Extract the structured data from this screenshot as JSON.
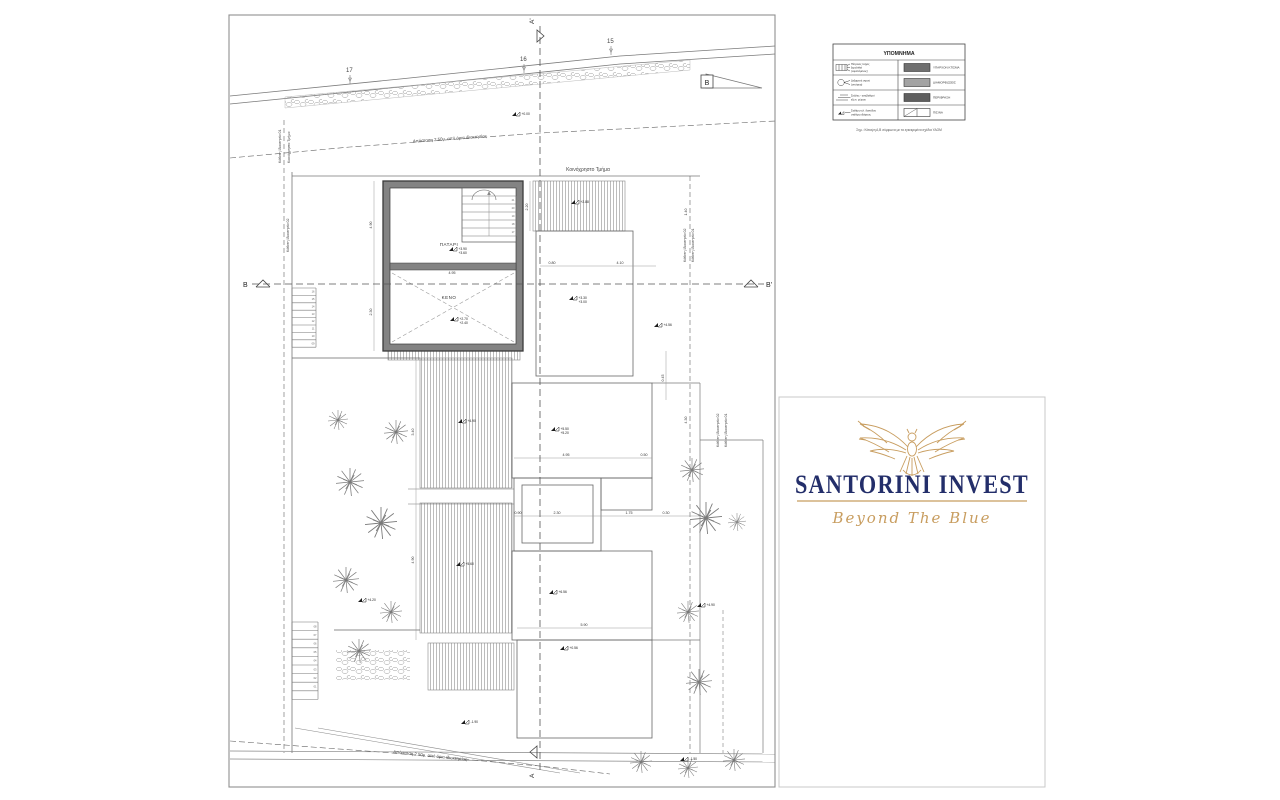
{
  "legend": {
    "title": "ΥΠΟΜΝΗΜΑ",
    "note": "Σημ.: Κάτοψη Α,Β σύμφωνα με τα εγκεκριμένα σχέδια ΥΔΟΜ",
    "rows": [
      {
        "symbol": "wall-marker",
        "label_lines": [
          "Πέτρινος τοίχος",
          "ξερολιθιά",
          "(υφιστάμενος)"
        ],
        "swatch": "#6f6f6f",
        "swatch_style": "solid",
        "swatch_label": "ΥΠΑΡΧΟΝ ΚΤΙΣΜΑ"
      },
      {
        "symbol": "circle-marker",
        "label_lines": [
          "Δεξαμενή νερού",
          "(υπόγεια)"
        ],
        "swatch": "#a3a3a3",
        "swatch_style": "solid",
        "swatch_label": "ΔΙΑΜΟΡΦΩΣΕΙΣ"
      },
      {
        "symbol": "steps-marker",
        "label_lines": [
          "Σκάλες - αναβαθμοί",
          "εξωτ. χώρου"
        ],
        "swatch": "#5f5f5f",
        "swatch_style": "solid",
        "swatch_label": "ΠΕΡΙΦΡΑΞΗ"
      },
      {
        "symbol": "level-marker",
        "label_lines": [
          "Στάθμη τελ. δαπέδου",
          "στάθμη εδάφους"
        ],
        "swatch": "#ffffff",
        "swatch_style": "split",
        "swatch_label": "ΠΙΣΙΝΑ"
      }
    ]
  },
  "logo": {
    "company": "SANTORINI INVEST",
    "tagline": "Beyond The Blue",
    "navy": "#232e6a",
    "gold": "#c89d5f",
    "icon": "eagle-icon"
  },
  "plan": {
    "labels": {
      "patari": "ΠΑΤΑΡΙ",
      "keno": "ΚΕΝΟ",
      "common_top": "Κοινόχρηστο Τμήμα",
      "left_boundary_a": "Κάθετη Ιδιοκτησία 01",
      "left_boundary_b": "Κοινόχρηστο Τμήμα",
      "left_boundary_c": "Κάθετη Ιδιοκτησία 02",
      "right_boundary_a": "Κάθετη Ιδιοκτησία 02",
      "right_boundary_b": "Κάθετη Ιδιοκτησία 01",
      "right_boundary_c": "Κάθετη Ιδιοκτησία 02",
      "right_boundary_d": "Κάθετη Ιδιοκτησία 01",
      "offset_top": "Απόσταση 2.50μ. από όρια ιδιοκτησίας",
      "offset_bottom": "Απόσταση 2.50μ. από όρια ιδιοκτησίας"
    },
    "sections": {
      "a_top": "A'",
      "a_bottom": "A",
      "b_left": "B",
      "b_right": "B'",
      "b_slope": "B"
    },
    "contours": [
      [
        346,
        72,
        "17"
      ],
      [
        520,
        61,
        "16"
      ],
      [
        607,
        43,
        "15"
      ]
    ],
    "level_markers": [
      [
        512,
        116,
        "+0.00"
      ],
      [
        449,
        251,
        "+3.90",
        "+3.60"
      ],
      [
        450,
        321,
        "+2.70",
        "+2.40"
      ],
      [
        571,
        204,
        "+2.88"
      ],
      [
        569,
        300,
        "+3.30",
        "+3.00"
      ],
      [
        654,
        327,
        "+4.56"
      ],
      [
        458,
        423,
        "+4.90"
      ],
      [
        551,
        431,
        "+5.50",
        "+5.20"
      ],
      [
        358,
        602,
        "+4.20"
      ],
      [
        456,
        566,
        "+5.60"
      ],
      [
        549,
        594,
        "+6.56"
      ],
      [
        697,
        607,
        "+4.90"
      ],
      [
        680,
        761,
        "-1.50"
      ],
      [
        461,
        724,
        "-1.90"
      ],
      [
        560,
        650,
        "+0.56"
      ]
    ],
    "dimensions": [
      [
        452,
        274,
        "4.95",
        0
      ],
      [
        552,
        264,
        "0.80",
        0
      ],
      [
        620,
        264,
        "4.10",
        0
      ],
      [
        372,
        225,
        "4.90",
        -90
      ],
      [
        372,
        312,
        "2.30",
        -90
      ],
      [
        528,
        207,
        "2.20",
        -90
      ],
      [
        687,
        212,
        "1.40",
        -90
      ],
      [
        687,
        420,
        "4.30",
        -90
      ],
      [
        566,
        456,
        "4.95",
        0
      ],
      [
        644,
        456,
        "0.50",
        0
      ],
      [
        518,
        514,
        "0.90",
        0
      ],
      [
        557,
        514,
        "2.30",
        0
      ],
      [
        629,
        514,
        "1.75",
        0
      ],
      [
        666,
        514,
        "0.30",
        0
      ],
      [
        584,
        626,
        "5.90",
        0
      ],
      [
        414,
        432,
        "3.40",
        -90
      ],
      [
        414,
        560,
        "4.90",
        -90
      ],
      [
        664,
        378,
        "0.45",
        -90
      ]
    ],
    "plants": [
      [
        338,
        420,
        1.0
      ],
      [
        396,
        432,
        1.2
      ],
      [
        350,
        482,
        1.4
      ],
      [
        381,
        523,
        1.6
      ],
      [
        346,
        580,
        1.3
      ],
      [
        391,
        612,
        1.1
      ],
      [
        359,
        651,
        1.2
      ],
      [
        692,
        470,
        1.2
      ],
      [
        706,
        518,
        1.6
      ],
      [
        737,
        522,
        0.9
      ],
      [
        688,
        612,
        1.1
      ],
      [
        699,
        682,
        1.3
      ],
      [
        641,
        762,
        1.1
      ],
      [
        688,
        768,
        1.0
      ],
      [
        734,
        760,
        1.1
      ]
    ],
    "stairs": [
      {
        "x": 292,
        "y": 288,
        "w": 24,
        "step": 7.4,
        "count": 9,
        "labels": [
          "16",
          "15",
          "14",
          "13",
          "12",
          "11",
          "10",
          "09"
        ]
      },
      {
        "x": 292,
        "y": 622,
        "w": 26,
        "step": 8.6,
        "count": 10,
        "labels": [
          "08",
          "07",
          "06",
          "05",
          "04",
          "03",
          "02",
          "01"
        ]
      },
      {
        "x": 462,
        "y": 196,
        "w": 54,
        "step": 8,
        "count": 6,
        "labels": [
          "21",
          "20",
          "19",
          "18",
          "17"
        ],
        "arrow": true
      }
    ]
  }
}
